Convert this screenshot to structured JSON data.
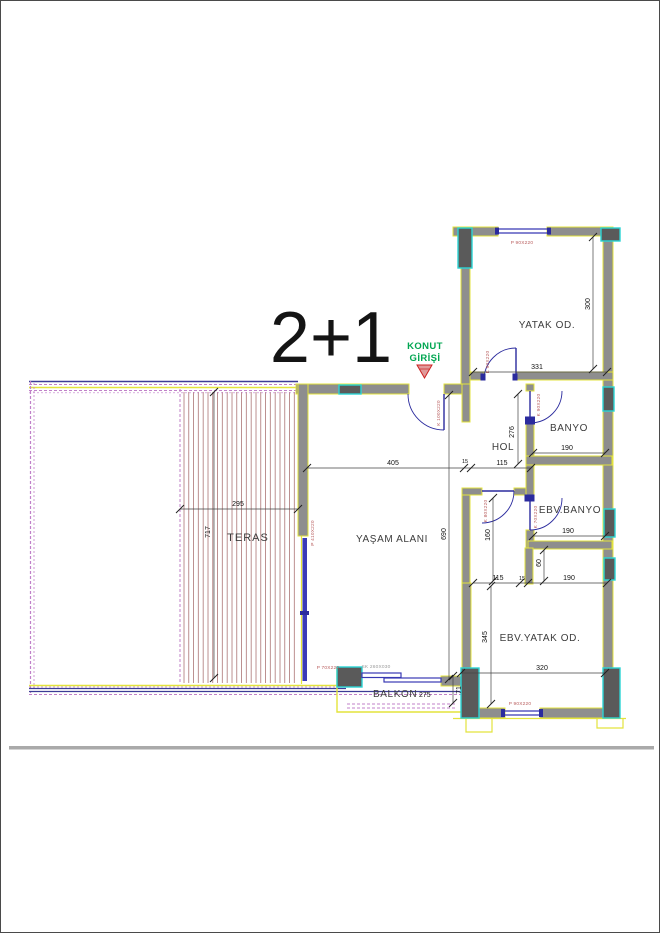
{
  "title": "2+1",
  "entry_label": {
    "line1": "KONUT",
    "line2": "GİRİŞİ"
  },
  "rooms": {
    "yatak": "YATAK OD.",
    "banyo": "BANYO",
    "hol": "HOL",
    "ebv_banyo": "EBV.BANYO",
    "ebv_yatak": "EBV.YATAK OD.",
    "yasam": "YAŞAM ALANI",
    "teras": "TERAS",
    "balkon": "BALKON"
  },
  "dims": {
    "yatak_w": "331",
    "yatak_h": "300",
    "banyo_w": "190",
    "banyo_h": "276",
    "hol_w": "115",
    "yasam_w": "405",
    "yasam_h": "690",
    "teras_w": "295",
    "teras_h": "717",
    "ebv_top_left": "115",
    "wall": "15",
    "ebv_top_right": "190",
    "ebv_banyo_w": "190",
    "ebv_banyo_niche": "60",
    "corridor_h": "160",
    "ebv_yatak_w": "320",
    "ebv_yatak_h": "345",
    "balkon_w": "275",
    "balkon_h": "71"
  },
  "openings": {
    "yatak_window": "P 90X220",
    "yatak_door": "K 90X220",
    "banyo_door": "K 90X220",
    "entry_door": "K 100X220",
    "corridor_door": "K 80X220",
    "ebv_banyo_door": "K 70X220",
    "ebv_yatak_window": "P 90X220",
    "yasam_slider": "P 410X220",
    "balkon_window": "P 70X220",
    "balkon_slider": "SK 260X030"
  },
  "colors": {
    "wall_fill": "#8e8e8e",
    "wall_edge": "#e3e33c",
    "column_edge": "#2bd4d4",
    "column_fill": "#5a5a5a",
    "door": "#2b2b9e",
    "window": "#3838b4",
    "terrace_hatch": "#a06060",
    "boundary_dashed": "#c080c8",
    "terrace_line": "#3c3c96",
    "entry_green": "#00a651",
    "label_red": "#b85c5c",
    "dim_text": "#111111"
  }
}
